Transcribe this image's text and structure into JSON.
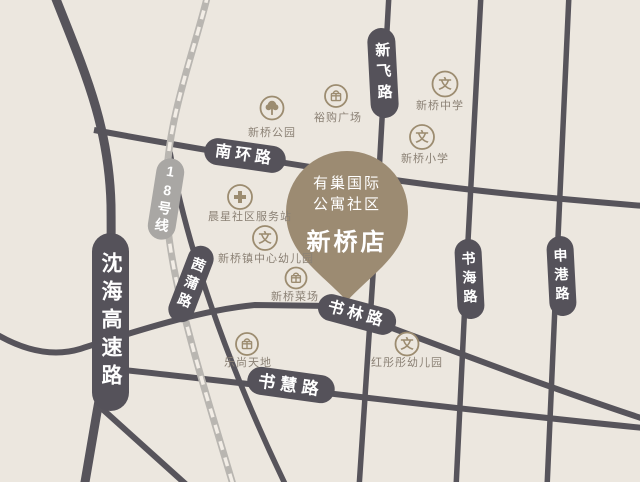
{
  "colors": {
    "background": "#ece7df",
    "road": "#57545b",
    "road_badge": "#55525a",
    "metro_badge": "#a9a7a4",
    "railway_casing": "#b9b6b1",
    "pin": "#9c8b72",
    "poi_icon": "#9c8c70",
    "poi_label": "#8b8175",
    "badge_text": "#ffffff"
  },
  "pin": {
    "line1": "有巢国际",
    "line2": "公寓社区",
    "store_name": "新桥店"
  },
  "roads": {
    "shenhai": {
      "label": "沈海高速路"
    },
    "nanhuan": {
      "label": "南环路"
    },
    "xinfei": {
      "label": "新飞路"
    },
    "shuhai": {
      "label": "书海路"
    },
    "shengang": {
      "label": "申港路"
    },
    "shulin": {
      "label": "书林路"
    },
    "shuhui": {
      "label": "书慧路"
    },
    "qianpu": {
      "label": "茜蒲路"
    }
  },
  "metro": {
    "label": "18号线"
  },
  "pois": [
    {
      "label": "新桥公园",
      "icon": "tree-icon"
    },
    {
      "label": "裕购广场",
      "icon": "gift-icon"
    },
    {
      "label": "新桥中学",
      "icon": "school-icon",
      "glyph": "文"
    },
    {
      "label": "新桥小学",
      "icon": "school-icon",
      "glyph": "文"
    },
    {
      "label": "晨星社区服务站",
      "icon": "clinic-icon"
    },
    {
      "label": "新桥镇中心幼儿园",
      "icon": "school-icon",
      "glyph": "文"
    },
    {
      "label": "新桥菜场",
      "icon": "gift-icon"
    },
    {
      "label": "乐尚天地",
      "icon": "gift-icon"
    },
    {
      "label": "红彤彤幼儿园",
      "icon": "school-icon",
      "glyph": "文"
    }
  ]
}
